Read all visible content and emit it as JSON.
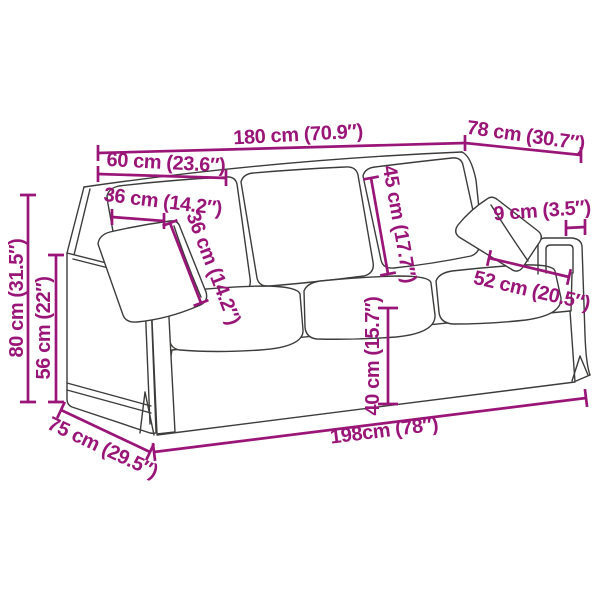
{
  "diagram": {
    "colors": {
      "dimension_accent": "#9A1578",
      "line_art": "#3C3C3B",
      "background": "#FFFFFF"
    },
    "dims": {
      "total_width": "180 cm (70.9″)",
      "total_depth": "78 cm (30.7″)",
      "section_width": "60 cm (23.6″)",
      "pillow_width": "36 cm (14.2″)",
      "pillow_height": "36 cm (14.2″)",
      "backrest_height": "45 cm (17.7″)",
      "armrest_width": "9 cm (3.5″)",
      "seat_depth": "52 cm (20.5″)",
      "total_height": "80 cm (31.5″)",
      "armrest_height": "56 cm (22″)",
      "seat_height": "40 cm (15.7″)",
      "base_length": "198cm (78″)",
      "base_depth": "75 cm (29.5″)"
    }
  }
}
